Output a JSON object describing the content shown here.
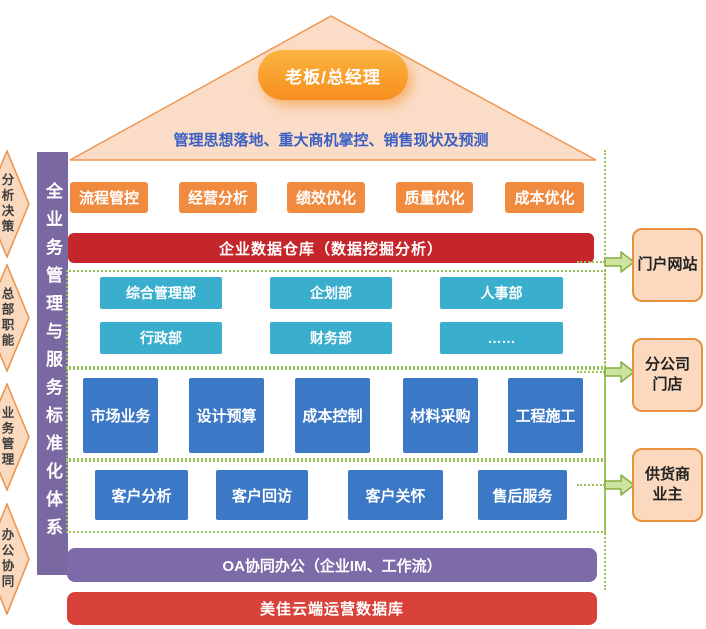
{
  "palette": {
    "orange": "#EF8A3E",
    "red_warehouse": "#C5262C",
    "red_database": "#D8423B",
    "teal": "#3AAECD",
    "blue": "#3B78C6",
    "purple_bar": "#7C6BA8",
    "purple_sidebar": "#7A68A3",
    "roof_fill": "#FBDCC6",
    "roof_border": "#EE9853",
    "peach_fill": "#FBD9BE",
    "dash_green": "#9CC35B",
    "arrow_green": "#CDE3A0",
    "subtitle_blue": "#3A5FC4"
  },
  "roof": {
    "badge": "老板/总经理",
    "subtitle": "管理思想落地、重大商机掌控、销售现状及预测"
  },
  "left_rail": {
    "sidebar_label": "全业务管理与服务标准化体系",
    "tags": [
      "分析决策",
      "总部职能",
      "业务管理",
      "办公协同"
    ]
  },
  "layers": {
    "strategy": {
      "items": [
        "流程管控",
        "经营分析",
        "绩效优化",
        "质量优化",
        "成本优化"
      ]
    },
    "warehouse": {
      "label": "企业数据仓库（数据挖掘分析）"
    },
    "departments": {
      "row1": [
        "综合管理部",
        "企划部",
        "人事部"
      ],
      "row2": [
        "行政部",
        "财务部",
        "……"
      ]
    },
    "business": {
      "items": [
        "市场业务",
        "设计预算",
        "成本控制",
        "材料采购",
        "工程施工"
      ]
    },
    "customer": {
      "items": [
        "客户分析",
        "客户回访",
        "客户关怀",
        "售后服务"
      ]
    },
    "oa": {
      "label": "OA协同办公（企业IM、工作流）"
    },
    "database": {
      "label": "美佳云端运营数据库"
    }
  },
  "right_rail": {
    "targets": [
      "门户网站",
      "分公司\n门店",
      "供货商\n业主"
    ]
  }
}
